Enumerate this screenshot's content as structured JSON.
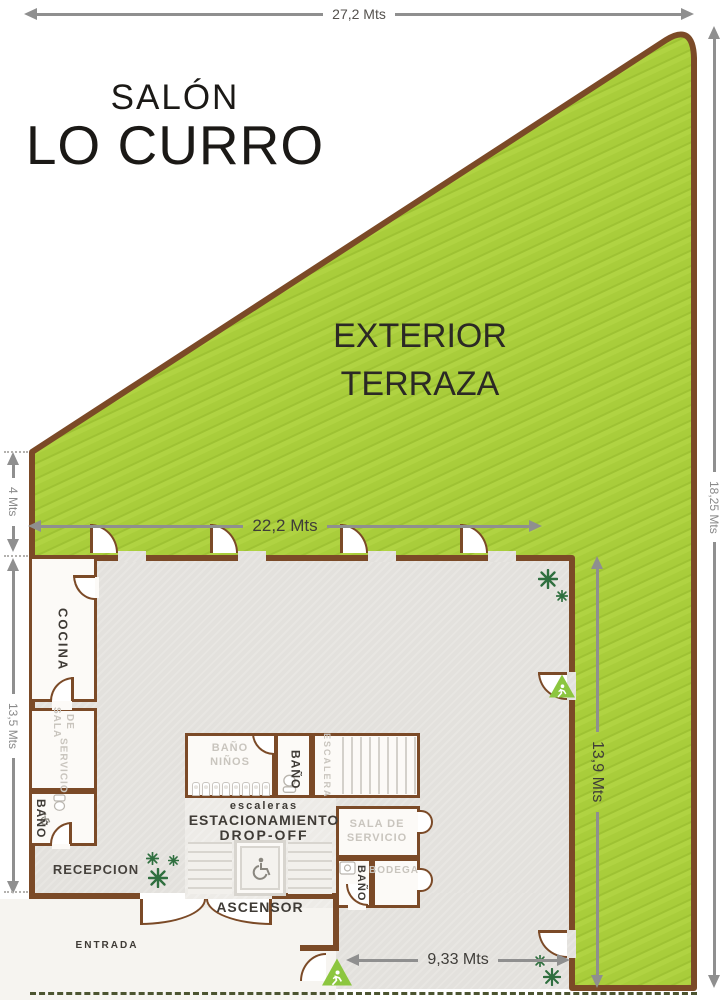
{
  "title": {
    "line1": "SALÓN",
    "line2": "LO CURRO"
  },
  "terrace": {
    "line1": "EXTERIOR",
    "line2": "TERRAZA"
  },
  "dimensions": {
    "top": "27,2 Mts",
    "left_upper": "4 Mts",
    "left_lower": "13,5 Mts",
    "right_outer": "18,25 Mts",
    "terrace_width": "22,2 Mts",
    "terrace_height": "13,9 Mts",
    "bottom": "9,33 Mts"
  },
  "rooms": {
    "cocina": "COCINA",
    "sala_servicio_left_line1": "SALA DE",
    "sala_servicio_left_line2": "SERVICIO",
    "bano_left": "BAÑO",
    "recepcion": "RECEPCION",
    "entrada": "ENTRADA",
    "bano_ninos_line1": "BAÑO",
    "bano_ninos_line2": "NIÑOS",
    "bano_center": "BAÑO",
    "escalera": "ESCALERA",
    "escaleras": "escaleras",
    "estacionamiento": "ESTACIONAMIENTO",
    "drop_off": "DROP-OFF",
    "ascensor": "ASCENSOR",
    "sala_servicio_right_line1": "SALA DE",
    "sala_servicio_right_line2": "SERVICIO",
    "bano_right": "BAÑO",
    "bodega": "BODEGA"
  },
  "icons": {
    "wheelchair": "wheelchair-icon",
    "exit_person": "exit-person-icon",
    "plant": "plant-icon",
    "toilet": "toilet-icon"
  },
  "colors": {
    "terrace_green": "#a9cd3b",
    "wall_brown": "#7b4a27",
    "floor_gray": "#e3e1dd",
    "dropoff_gray": "#edebe7",
    "exit_green": "#8cc63f",
    "plant_green": "#2f6f3f",
    "dimension_gray": "#8f8f8f"
  }
}
